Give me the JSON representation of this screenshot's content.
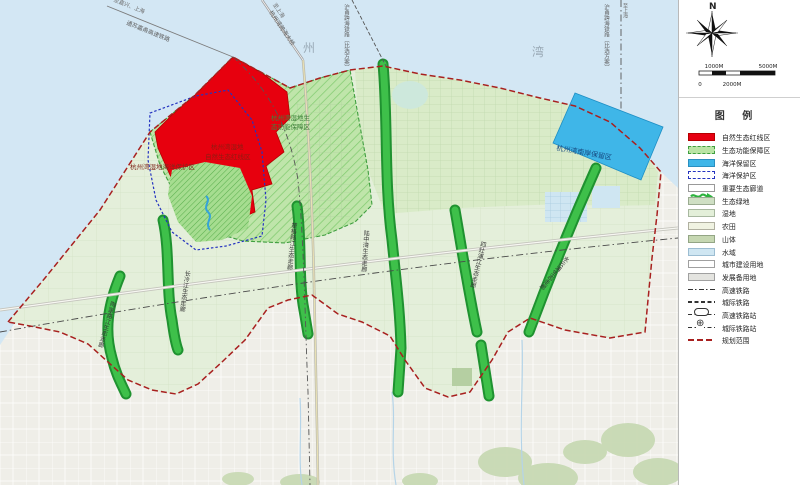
{
  "map": {
    "sea_name_chars": [
      "州",
      "湾"
    ],
    "zones": {
      "red_line1": "杭州湾湿地",
      "red_line2": "自然生态红线区",
      "function_line1": "杭州湾湿地生",
      "function_line2": "态功能保障区",
      "marine_protected": "杭州湾湿地海洋保护区",
      "marine_reserve": "杭州湾南岸保留区"
    },
    "corridors": [
      "陶家路江生态走廊",
      "长冷江生态走廊",
      "楚格路江生态走廊",
      "陆中湾生态走廊",
      "四灶浦江生态走廊",
      "水云浦生态走廊"
    ],
    "transport": {
      "to_jiaxing_shanghai": "至嘉兴、上海",
      "tongsujiayong": "通苏嘉甬高速铁路",
      "to_shanghai_1": "至上海",
      "bridge": "杭州湾跨海大桥",
      "huyong_west": "沪甬跨海铁路（比选方案）",
      "huyong_east": "沪甬跨海铁路（比选方案）",
      "to_shanghai_2": "至上海"
    }
  },
  "compass": {
    "north": "N"
  },
  "scalebar": {
    "top_left": "1000M",
    "top_right": "5000M",
    "bottom_left": "0",
    "bottom_mid": "2000M"
  },
  "legend": {
    "title": "图  例",
    "items": [
      {
        "label": "自然生态红线区",
        "type": "fill",
        "color": "#e60012",
        "border": "#b50000"
      },
      {
        "label": "生态功能保障区",
        "type": "fill-dash",
        "color": "#b9e4a4",
        "border": "#3f9e3f"
      },
      {
        "label": "海洋保留区",
        "type": "fill",
        "color": "#3fb6e8",
        "border": "#2a8fc0"
      },
      {
        "label": "海洋保护区",
        "type": "fill-dash",
        "color": "#ffffff",
        "border": "#2433c0"
      },
      {
        "label": "重要生态廊道",
        "type": "corridor",
        "color": "#2db33e"
      },
      {
        "label": "生态绿地",
        "type": "fill",
        "color": "#cfdfc4",
        "border": "#9aab90"
      },
      {
        "label": "湿地",
        "type": "fill",
        "color": "#e3efd9",
        "border": "#a8b8a0"
      },
      {
        "label": "农田",
        "type": "fill",
        "color": "#f0f3e2",
        "border": "#b0b0a0"
      },
      {
        "label": "山体",
        "type": "fill",
        "color": "#c6d7b2",
        "border": "#93a585"
      },
      {
        "label": "水域",
        "type": "fill",
        "color": "#cfe6f2",
        "border": "#9cbdd2"
      },
      {
        "label": "城市建设用地",
        "type": "fill",
        "color": "#ffffff",
        "border": "#a0a0a0"
      },
      {
        "label": "发展备用地",
        "type": "fill",
        "color": "#e4e4e0",
        "border": "#a0a0a0"
      },
      {
        "label": "高速铁路",
        "type": "dashdot",
        "color": "#333333"
      },
      {
        "label": "城际铁路",
        "type": "dashed",
        "color": "#333333"
      },
      {
        "label": "高速铁路站",
        "type": "station-hsr",
        "color": "#333333"
      },
      {
        "label": "城际铁路站",
        "type": "station-icr",
        "color": "#333333"
      },
      {
        "label": "规划范围",
        "type": "plan-dash",
        "color": "#a8201f"
      }
    ]
  }
}
